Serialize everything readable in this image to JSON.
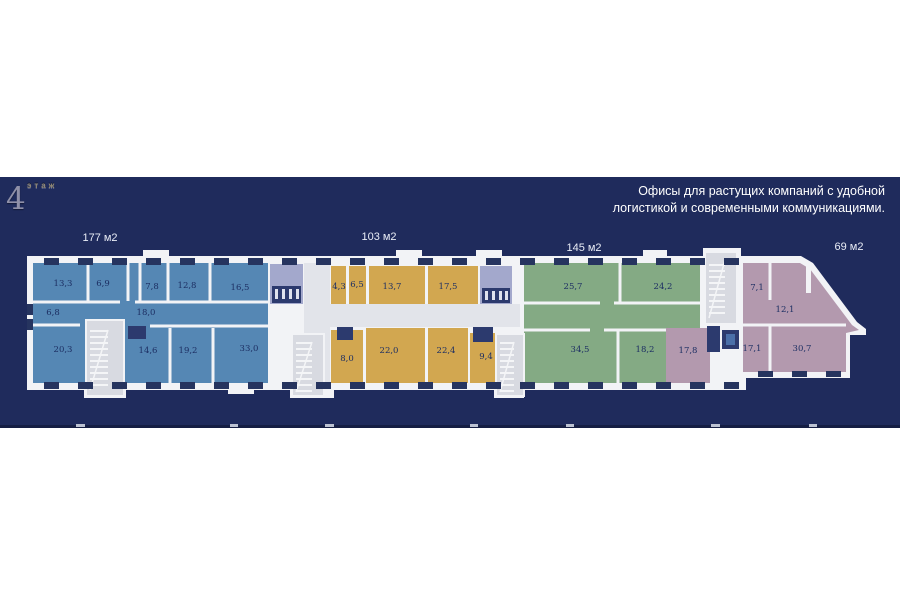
{
  "header": {
    "floor_label": "этаж",
    "floor_number": "4",
    "tagline_line1": "Офисы для растущих компаний с удобной",
    "tagline_line2": "логистикой и современными коммуникациями."
  },
  "sections": [
    {
      "name": "office-177",
      "area_label": "177 м2",
      "color": "#5587b4",
      "rooms": [
        "13,3",
        "6,9",
        "7,8",
        "12,8",
        "16,5",
        "6,8",
        "18,0",
        "20,3",
        "14,6",
        "19,2",
        "33,0"
      ]
    },
    {
      "name": "office-103",
      "area_label": "103 м2",
      "color": "#d2a750",
      "rooms": [
        "4,3",
        "6,5",
        "13,7",
        "17,5",
        "8,0",
        "22,0",
        "22,4",
        "9,4"
      ]
    },
    {
      "name": "office-145",
      "area_label": "145 м2",
      "color": "#84aa84",
      "rooms": [
        "25,7",
        "24,2",
        "34,5",
        "18,2"
      ]
    },
    {
      "name": "office-69",
      "area_label": "69 м2",
      "color": "#b399ae",
      "rooms": [
        "7,1",
        "12,1",
        "17,1",
        "30,7",
        "17,8"
      ]
    }
  ],
  "colors": {
    "banner": "#1f2b5c",
    "banner_bottom_strip": "#151e43",
    "walls": "#f2f3f6",
    "corridor": "#e2e4ea",
    "stairwell": "#d8dae1",
    "utility_dark": "#2c3a6e",
    "wc_room": "#a3a8cc",
    "window_pillar": "#26345f",
    "room_text": "#1d2f63"
  }
}
